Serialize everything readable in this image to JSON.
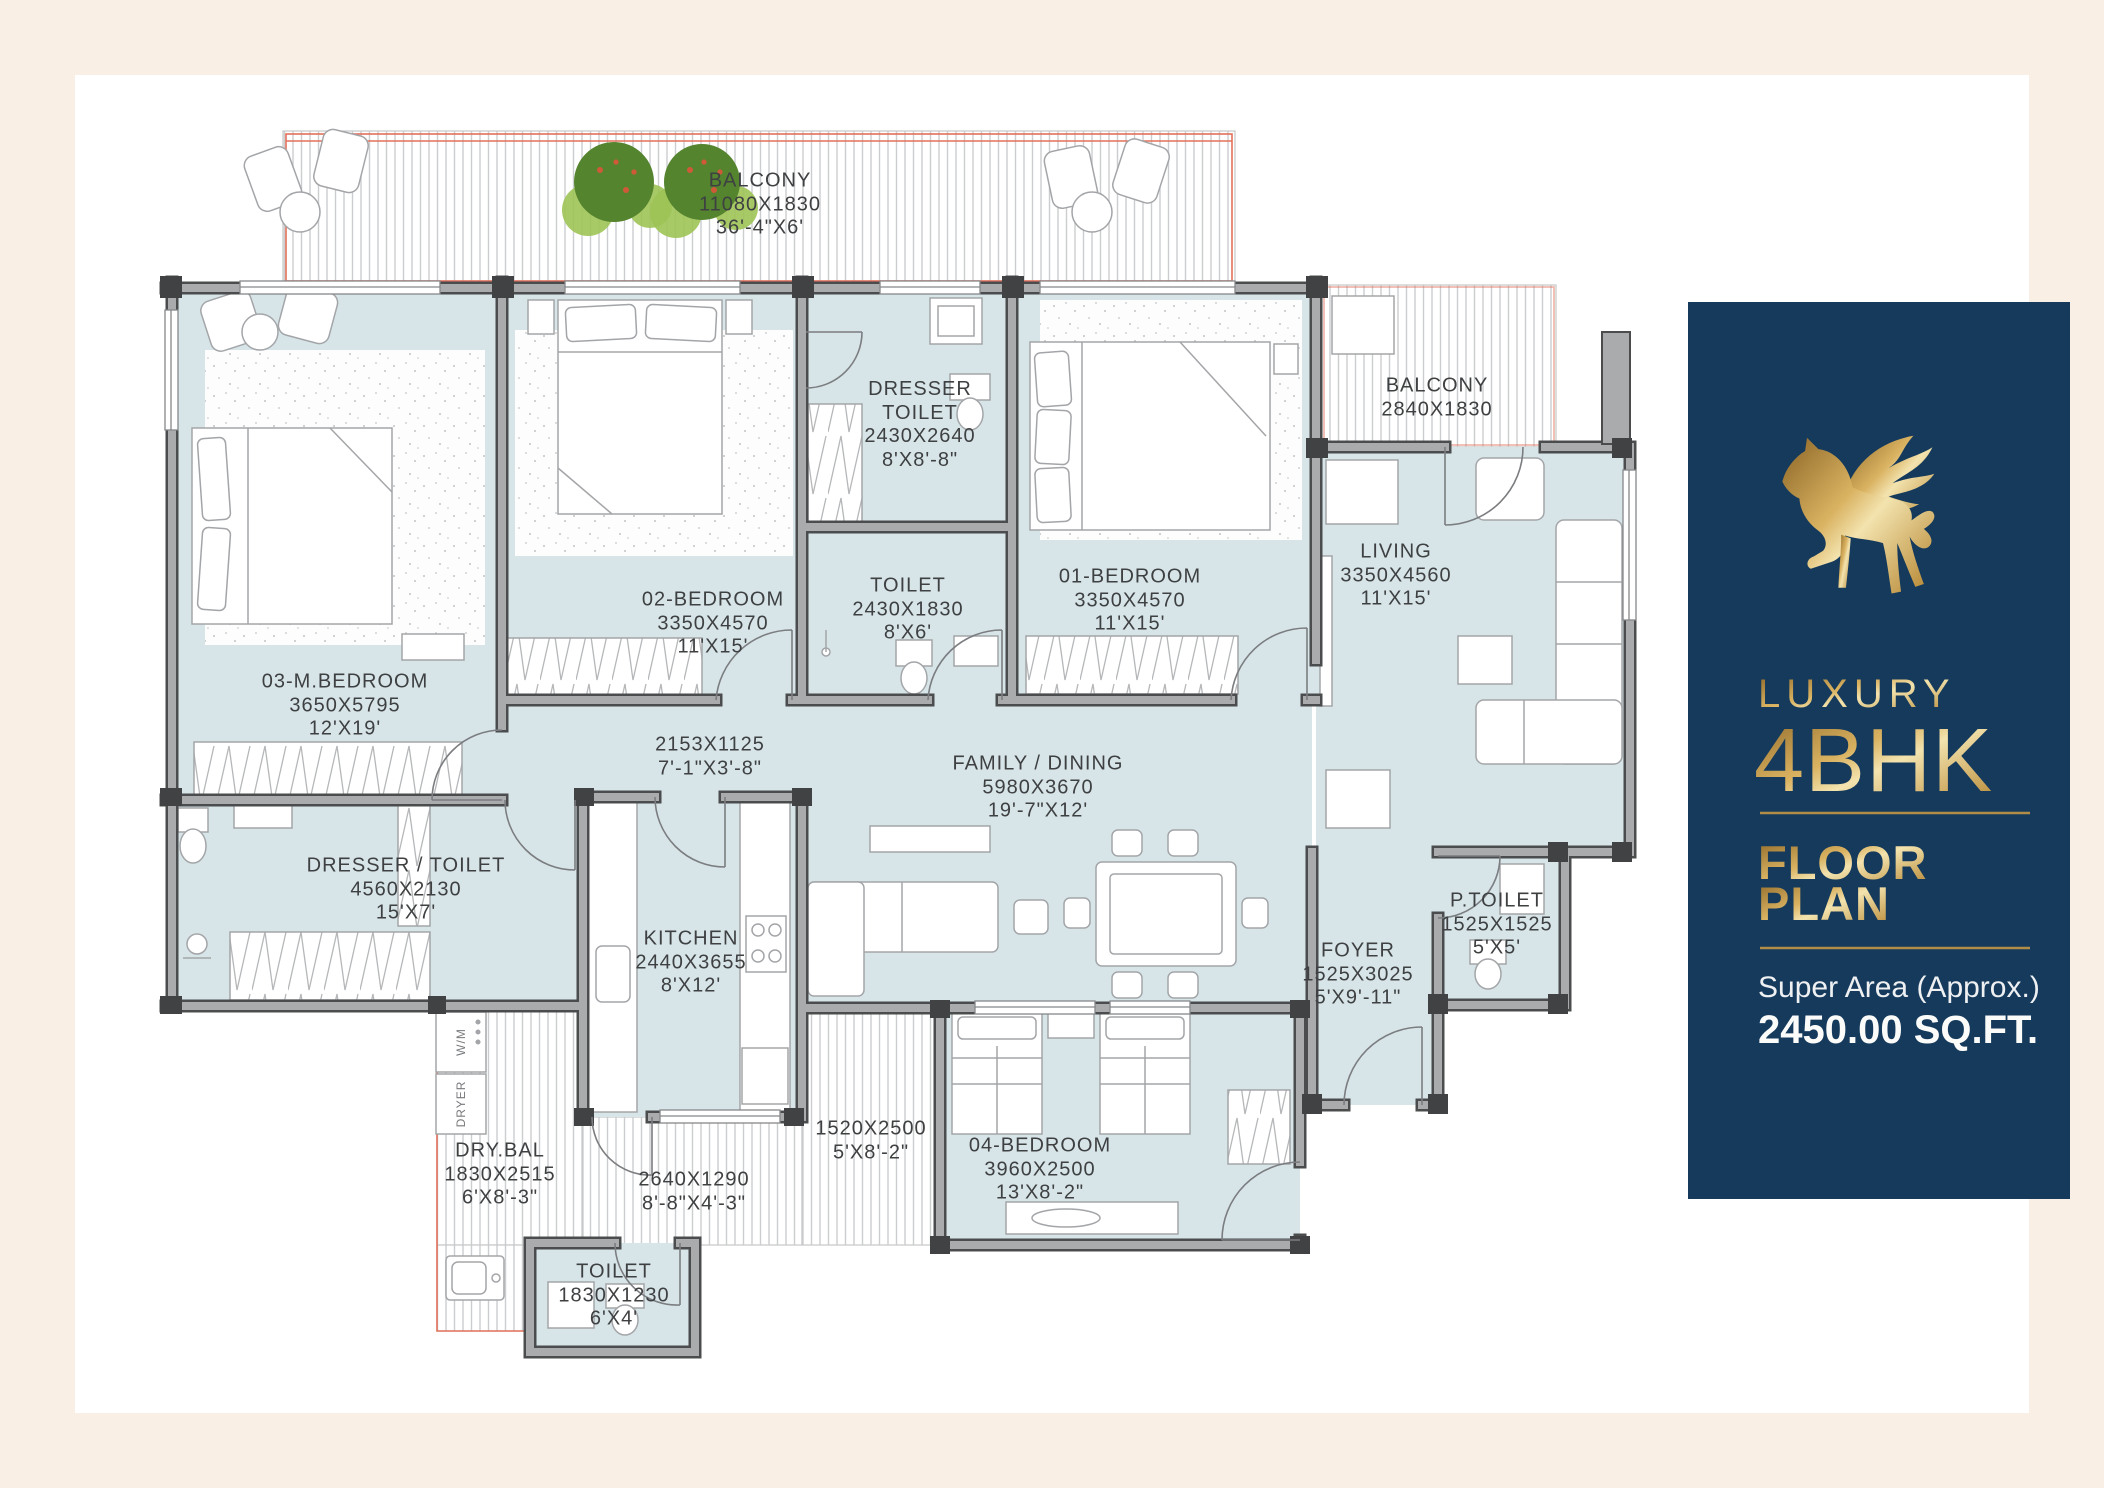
{
  "panel": {
    "title_line1": "LUXURY",
    "title_line2": "4BHK",
    "subtitle_line1": "FLOOR",
    "subtitle_line2": "PLAN",
    "area_label": "Super Area (Approx.)",
    "area_value": "2450.00 SQ.FT."
  },
  "rooms": [
    {
      "name": "BALCONY",
      "metric": "11080X1830",
      "imperial": "36'-4\"X6'"
    },
    {
      "name": "BALCONY",
      "metric": "2840X1830",
      "imperial": "9'-4\"X6'"
    },
    {
      "name": "03-M.BEDROOM",
      "metric": "3650X5795",
      "imperial": "12'X19'"
    },
    {
      "name": "02-BEDROOM",
      "metric": "3350X4570",
      "imperial": "11'X15'"
    },
    {
      "name": "DRESSER TOILET",
      "metric": "2430X2640",
      "imperial": "8'X8'-8\""
    },
    {
      "name": "TOILET",
      "metric": "2430X1830",
      "imperial": "8'X6'"
    },
    {
      "name": "01-BEDROOM",
      "metric": "3350X4570",
      "imperial": "11'X15'"
    },
    {
      "name": "LIVING",
      "metric": "3350X4560",
      "imperial": "11'X15'"
    },
    {
      "name": "",
      "metric": "2153X1125",
      "imperial": "7'-1\"X3'-8\""
    },
    {
      "name": "FAMILY / DINING",
      "metric": "5980X3670",
      "imperial": "19'-7\"X12'"
    },
    {
      "name": "DRESSER / TOILET",
      "metric": "4560X2130",
      "imperial": "15'X7'"
    },
    {
      "name": "KITCHEN",
      "metric": "2440X3655",
      "imperial": "8'X12'"
    },
    {
      "name": "P.TOILET",
      "metric": "1525X1525",
      "imperial": "5'X5'"
    },
    {
      "name": "FOYER",
      "metric": "1525X3025",
      "imperial": "5'X9'-11\""
    },
    {
      "name": "",
      "metric": "1520X2500",
      "imperial": "5'X8'-2\""
    },
    {
      "name": "04-BEDROOM",
      "metric": "3960X2500",
      "imperial": "13'X8'-2\""
    },
    {
      "name": "DRY.BAL",
      "metric": "1830X2515",
      "imperial": "6'X8'-3\""
    },
    {
      "name": "",
      "metric": "2640X1290",
      "imperial": "8'-8\"X4'-3\""
    },
    {
      "name": "TOILET",
      "metric": "1830X1230",
      "imperial": "6'X4'"
    }
  ],
  "appliances": {
    "wm": "W/M",
    "dryer": "DRYER"
  },
  "colors": {
    "page_bg": "#f9efe4",
    "sheet_bg": "#ffffff",
    "room_fill": "#d7e5e9",
    "wall_dark": "#4b4c4e",
    "wall_gray": "#a9abad",
    "accent_red": "#e3715c",
    "navy": "#153a5c",
    "gold": "#caa355",
    "label_text": "#3e4042"
  }
}
